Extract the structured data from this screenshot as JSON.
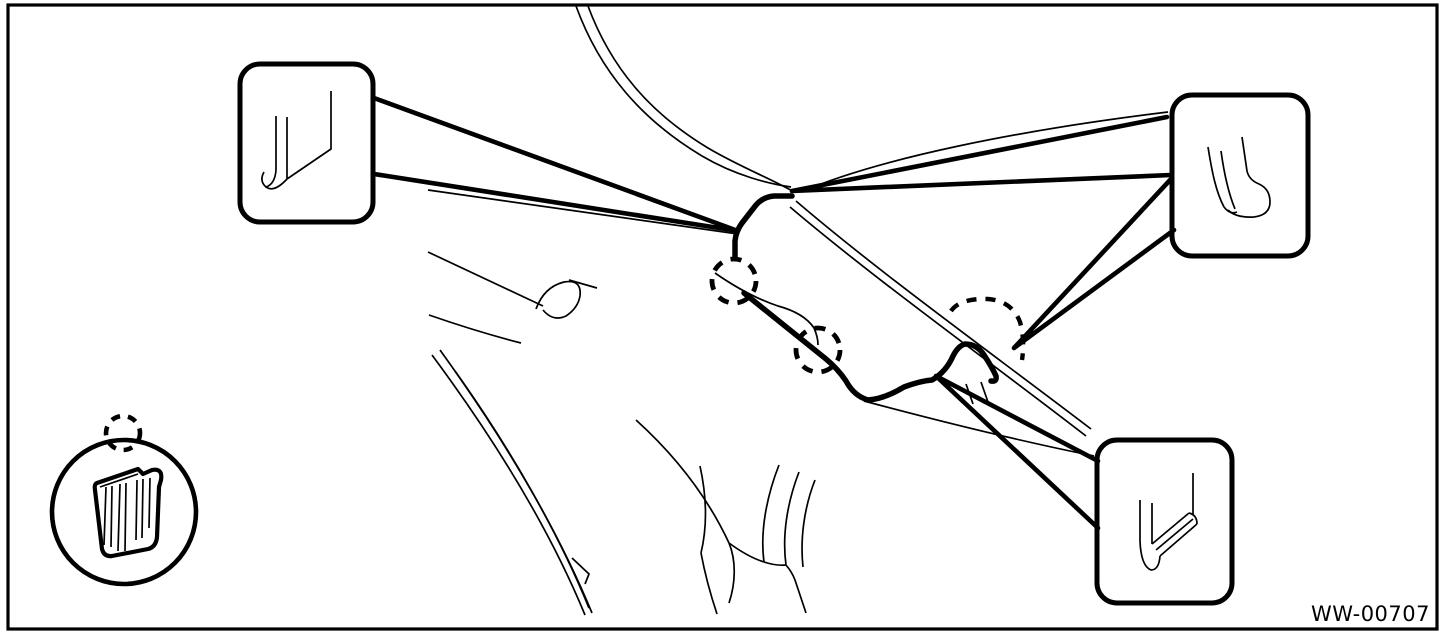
{
  "figure": {
    "code": "WW-00707"
  },
  "colors": {
    "ink": "#000000",
    "paper": "#ffffff"
  },
  "icons": {
    "legend_clip": "hose-routing-clip-icon",
    "legend_marker": "dashed-circle-clip-marker",
    "callout_top_left": "hose-end-straight-icon",
    "callout_top_right": "hose-end-elbow-icon",
    "callout_bottom_right": "hose-end-nozzle-icon"
  },
  "clip_markers_in_drawing": 3
}
